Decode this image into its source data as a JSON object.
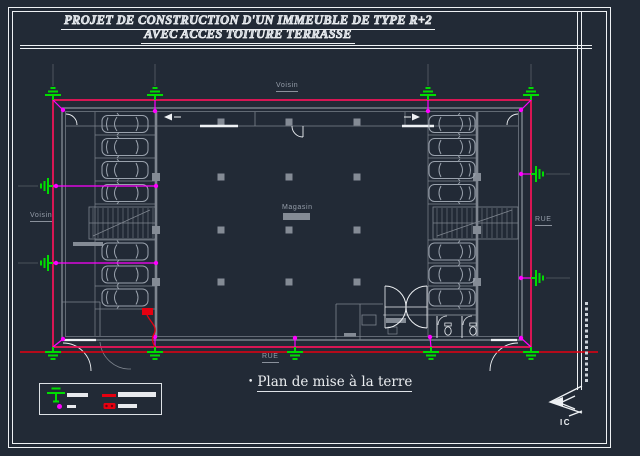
{
  "colors": {
    "background": "#222a36",
    "frame_white": "#eef1f4",
    "wall_gray": "#7e858f",
    "car_gray": "#9aa2ad",
    "column_gray": "#848b95",
    "label_gray": "#969eaa",
    "ref_gray": "#596069",
    "loop_pink": "#ed1558",
    "dot_magenta": "#ff00ff",
    "earth_green": "#00dd00",
    "red": "#e60010"
  },
  "title_block": {
    "line1": "PROJET DE CONSTRUCTION D'UN IMMEUBLE DE TYPE R+2",
    "line2": "AVEC ACCES TOITURE TERRASSE"
  },
  "plan": {
    "labels": {
      "neighbor_top": "Voisin",
      "neighbor_left": "Voisin",
      "street_right": "RUE",
      "street_bottom": "RUE",
      "shop": "Magasin"
    },
    "caption": {
      "bullet": "•",
      "text": "Plan de mise à la terre"
    }
  },
  "legend": {
    "items": [
      {
        "icon": "earth-electrode-symbol",
        "color": "#00dd00"
      },
      {
        "icon": "connection-point-dot",
        "color": "#ff00ff"
      },
      {
        "icon": "earth-conductor-line",
        "color": "#e60010"
      },
      {
        "icon": "measuring-disconnect-strip",
        "color": "#e60010"
      }
    ],
    "label_style": "illegible-bars"
  },
  "logo": {
    "text": "IC"
  }
}
